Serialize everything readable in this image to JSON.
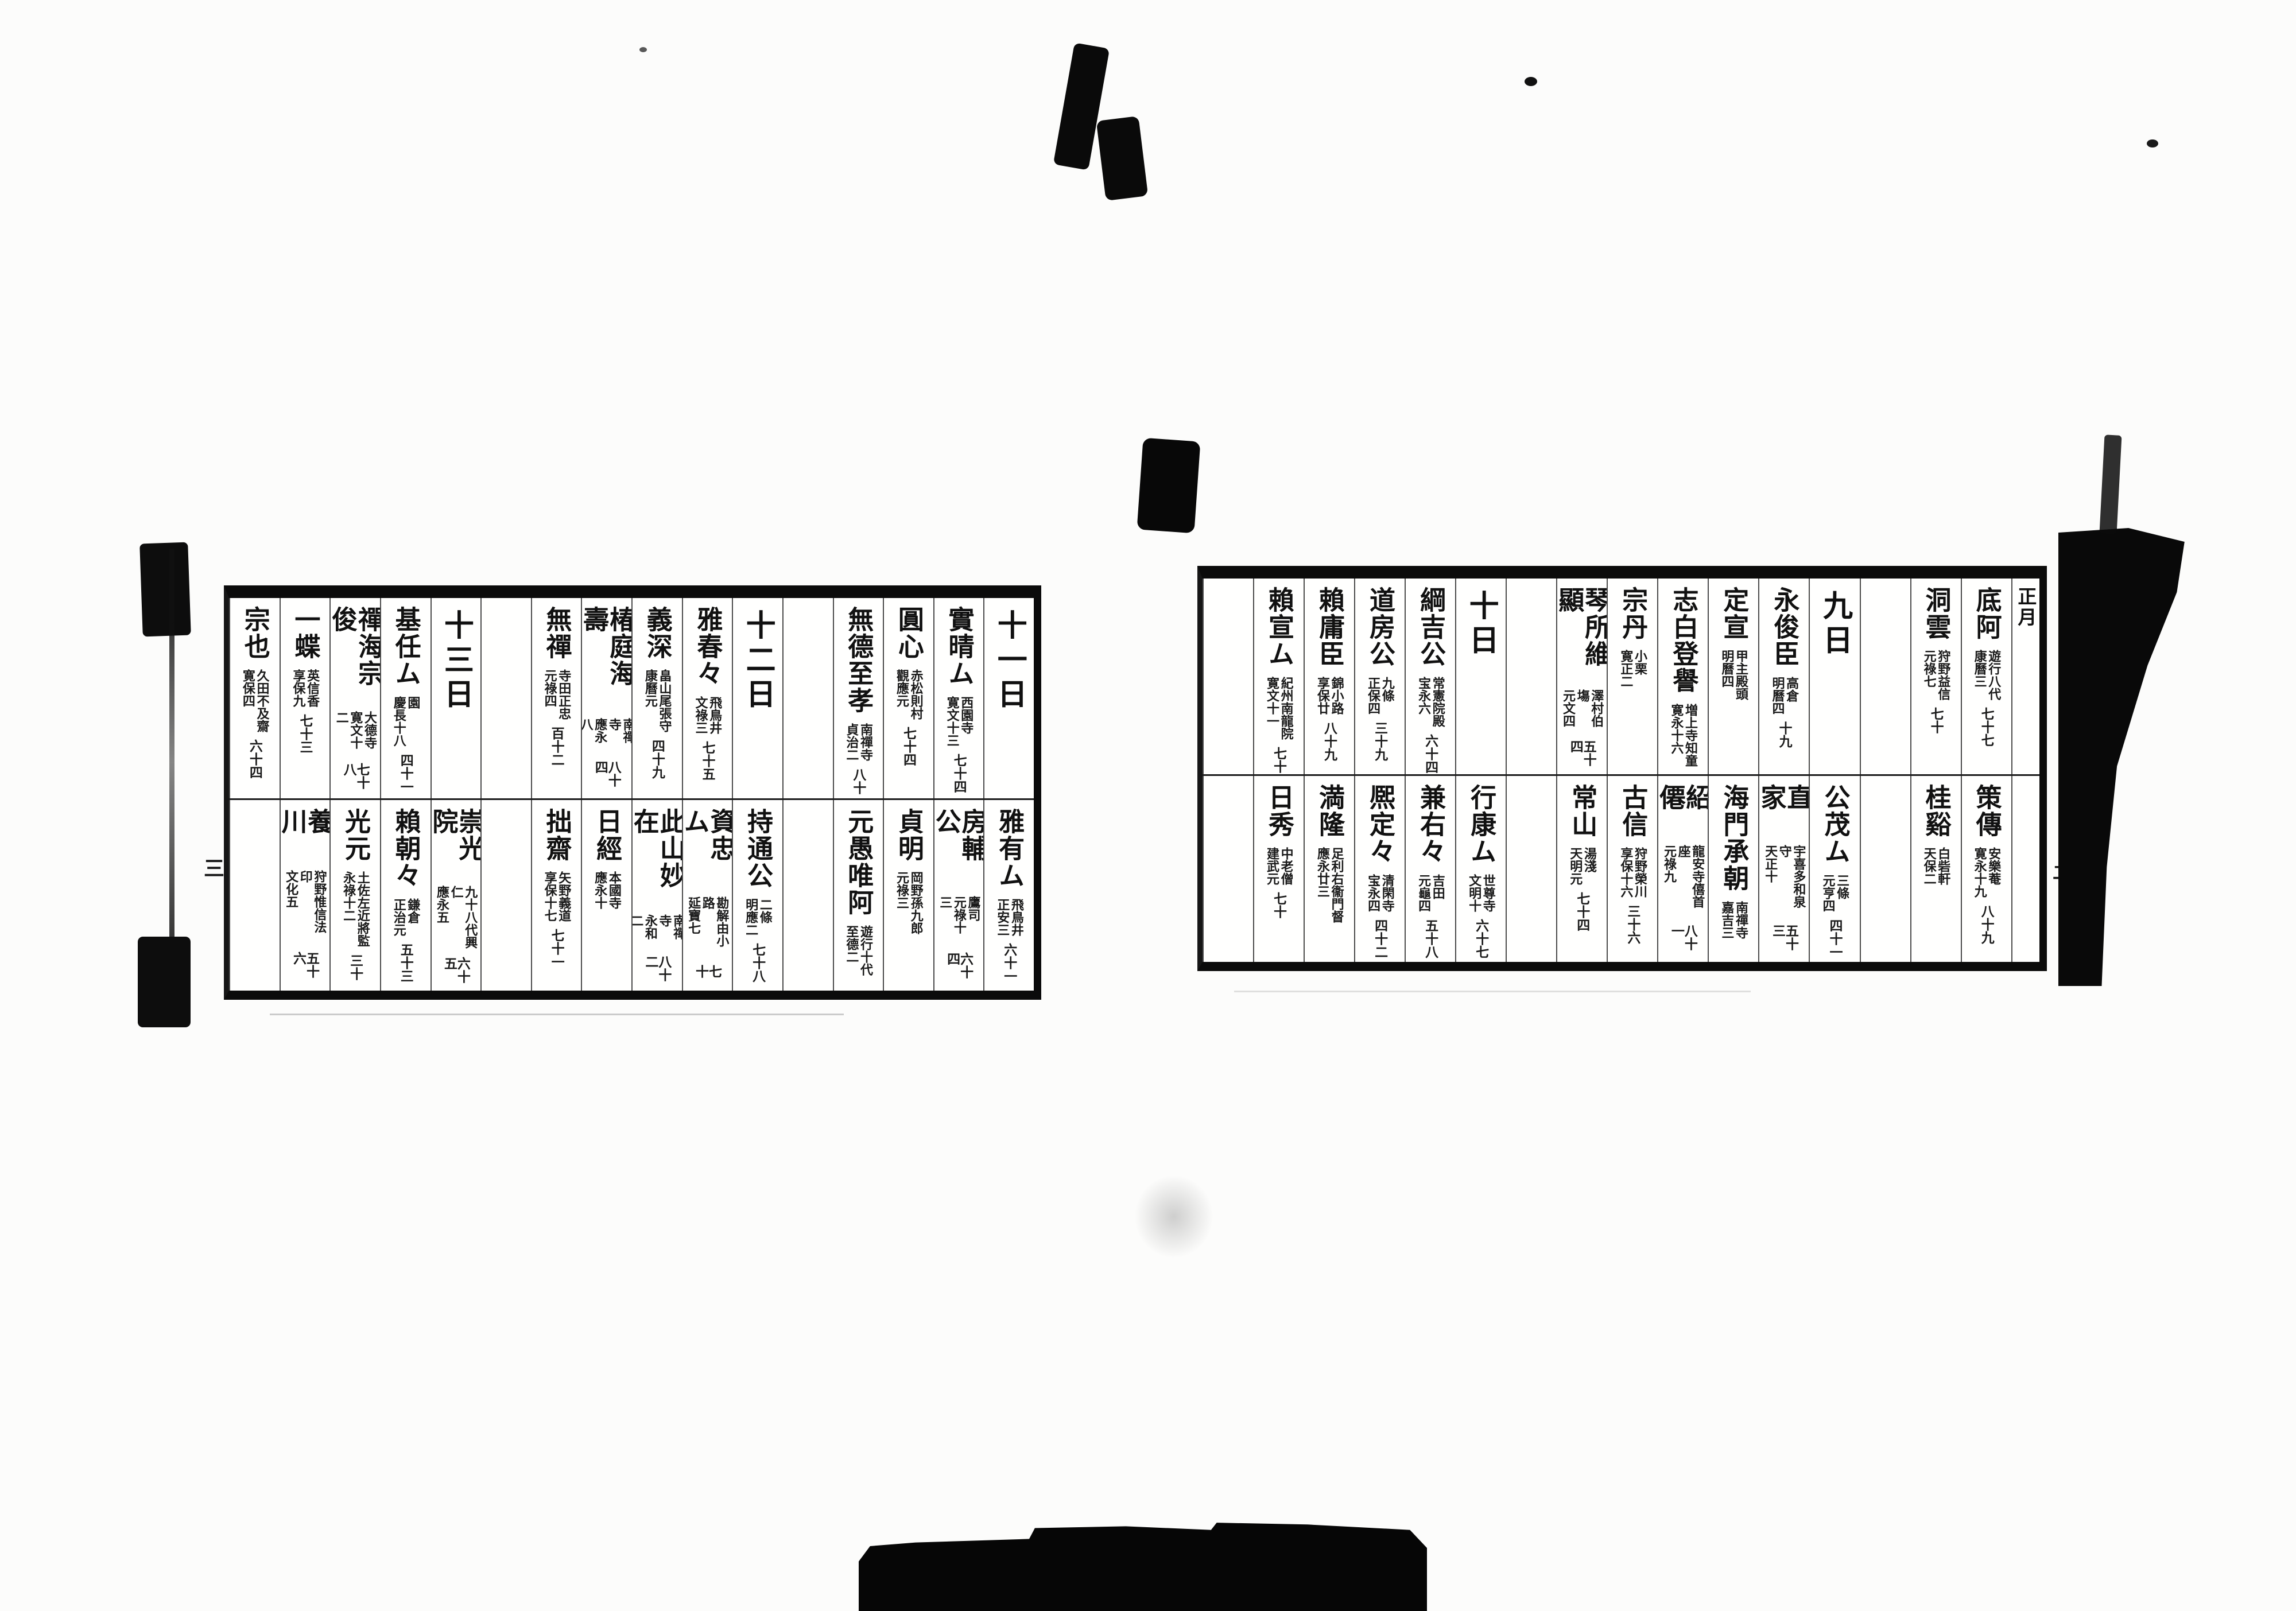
{
  "spread": {
    "pages": {
      "right": {
        "page_number": "二",
        "columns": [
          {
            "narrow": true,
            "top": {
              "header": "正月",
              "month": true
            },
            "bottom": null
          },
          {
            "top": {
              "name": "底阿",
              "note1": "遊行八代",
              "note2": "康曆三",
              "age": "七十七"
            },
            "bottom": {
              "name": "策傳",
              "note1": "安樂菴",
              "note2": "寛永十九",
              "age": "八十九"
            }
          },
          {
            "top": {
              "name": "洞雲",
              "note1": "狩野益信",
              "note2": "元祿七",
              "age": "七十"
            },
            "bottom": {
              "name": "桂谿",
              "note1": "白砦軒",
              "note2": "天保二",
              "age": ""
            }
          },
          {
            "top": null,
            "bottom": null
          },
          {
            "top": {
              "header": "九日"
            },
            "bottom": {
              "name": "公茂ム",
              "note1": "三條",
              "note2": "元亨四",
              "age": "四十一"
            }
          },
          {
            "top": {
              "name": "永俊臣",
              "note1": "高倉",
              "note2": "明曆四",
              "age": "十九"
            },
            "bottom": {
              "name": "直家",
              "note1": "宇喜多和泉守",
              "note2": "天正十",
              "age": "五十三"
            }
          },
          {
            "top": {
              "name": "定宣",
              "note1": "甲主殿頭",
              "note2": "明曆四",
              "age": ""
            },
            "bottom": {
              "name": "海門承朝",
              "note1": "南禪寺",
              "note2": "嘉吉三",
              "age": ""
            }
          },
          {
            "top": {
              "name": "志白登譽",
              "note1": "増上寺知童",
              "note2": "寛永十六",
              "age": ""
            },
            "bottom": {
              "name": "紹僊",
              "note1": "龍安寺僖首座",
              "note2": "元祿九",
              "age": "八十一"
            }
          },
          {
            "top": {
              "name": "宗丹",
              "note1": "小栗",
              "note2": "寛正二",
              "age": ""
            },
            "bottom": {
              "name": "古信",
              "note1": "狩野榮川",
              "note2": "享保十六",
              "age": "三十六"
            }
          },
          {
            "top": {
              "name": "琴所維顯",
              "note1": "澤村伯塲",
              "note2": "元文四",
              "age": "五十四"
            },
            "bottom": {
              "name": "常山",
              "note1": "湯淺",
              "note2": "天明元",
              "age": "七十四"
            }
          },
          {
            "top": null,
            "bottom": null
          },
          {
            "top": {
              "header": "十日"
            },
            "bottom": {
              "name": "行康ム",
              "note1": "世尊寺",
              "note2": "文明十",
              "age": "六十七"
            }
          },
          {
            "top": {
              "name": "綱吉公",
              "note1": "常憲院殿",
              "note2": "宝永六",
              "age": "六十四"
            },
            "bottom": {
              "name": "兼右々",
              "note1": "吉田",
              "note2": "元龜四",
              "age": "五十八"
            }
          },
          {
            "top": {
              "name": "道房公",
              "note1": "九條",
              "note2": "正保四",
              "age": "三十九"
            },
            "bottom": {
              "name": "熈定々",
              "note1": "清閑寺",
              "note2": "宝永四",
              "age": "四十二"
            }
          },
          {
            "top": {
              "name": "賴庸臣",
              "note1": "錦小路",
              "note2": "享保廿",
              "age": "八十九"
            },
            "bottom": {
              "name": "満隆",
              "note1": "足利右衞門督",
              "note2": "應永廿三",
              "age": ""
            }
          },
          {
            "top": {
              "name": "賴宣ム",
              "note1": "紀州南龍院",
              "note2": "寛文十一",
              "age": "七十"
            },
            "bottom": {
              "name": "日秀",
              "note1": "中老僧",
              "note2": "建武元",
              "age": "七十"
            }
          },
          {
            "top": null,
            "bottom": null
          }
        ]
      },
      "left": {
        "page_number": "三",
        "columns": [
          {
            "top": {
              "header": "十一日"
            },
            "bottom": {
              "name": "雅有ム",
              "note1": "飛鳥井",
              "note2": "正安三",
              "age": "六十一"
            }
          },
          {
            "top": {
              "name": "實晴ム",
              "note1": "西園寺",
              "note2": "寛文十三",
              "age": "七十四"
            },
            "bottom": {
              "name": "房輔公",
              "note1": "鷹司",
              "note2": "元祿十三",
              "age": "六十四"
            }
          },
          {
            "top": {
              "name": "圓心",
              "note1": "赤松則村",
              "note2": "觀應元",
              "age": "七十四"
            },
            "bottom": {
              "name": "貞明",
              "note1": "岡野孫九郎",
              "note2": "元祿三",
              "age": ""
            }
          },
          {
            "top": {
              "name": "無德至孝",
              "note1": "南禪寺",
              "note2": "貞治二",
              "age": "八十"
            },
            "bottom": {
              "name": "元愚唯阿",
              "note1": "遊行十代",
              "note2": "至德二",
              "age": ""
            }
          },
          {
            "top": null,
            "bottom": null
          },
          {
            "top": {
              "header": "十二日"
            },
            "bottom": {
              "name": "持通公",
              "note1": "二條",
              "note2": "明應二",
              "age": "七十八"
            }
          },
          {
            "top": {
              "name": "雅春々",
              "note1": "飛鳥井",
              "note2": "文祿三",
              "age": "七十五"
            },
            "bottom": {
              "name": "資忠ム",
              "note1": "勘解由小路",
              "note2": "延寶七",
              "age": "七十"
            }
          },
          {
            "top": {
              "name": "義深",
              "note1": "畠山尾張守",
              "note2": "康曆元",
              "age": "四十九"
            },
            "bottom": {
              "name": "此山妙在",
              "note1": "南禪寺",
              "note2": "永和二",
              "age": "八十二"
            }
          },
          {
            "top": {
              "name": "椿庭海壽",
              "note1": "南禪寺",
              "note2": "應永八",
              "age": "八十四"
            },
            "bottom": {
              "name": "日經",
              "note1": "本國寺",
              "note2": "應永十",
              "age": ""
            }
          },
          {
            "top": {
              "name": "無禪",
              "note1": "寺田正忠",
              "note2": "元祿四",
              "age": "百十二"
            },
            "bottom": {
              "name": "拙齋",
              "note1": "矢野義道",
              "note2": "享保十七",
              "age": "七十一"
            }
          },
          {
            "top": null,
            "bottom": null
          },
          {
            "top": {
              "header": "十三日"
            },
            "bottom": {
              "name": "崇光院",
              "note1": "九十八代興仁",
              "note2": "應永五",
              "age": "六十五"
            }
          },
          {
            "top": {
              "name": "基任ム",
              "note1": "園",
              "note2": "慶長十八",
              "age": "四十一"
            },
            "bottom": {
              "name": "賴朝々",
              "note1": "鎌倉",
              "note2": "正治元",
              "age": "五十三"
            }
          },
          {
            "top": {
              "name": "禪海宗俊",
              "note1": "大德寺",
              "note2": "寛文十二",
              "age": "七十八"
            },
            "bottom": {
              "name": "光元",
              "note1": "土佐左近將監",
              "note2": "永祿十二",
              "age": "三十"
            }
          },
          {
            "top": {
              "name": "一蝶",
              "note1": "英信香",
              "note2": "享保九",
              "age": "七十三"
            },
            "bottom": {
              "name": "養川",
              "note1": "狩野惟信法印",
              "note2": "文化五",
              "age": "五十六"
            }
          },
          {
            "top": {
              "name": "宗也",
              "note1": "久田不及齋",
              "note2": "寛保四",
              "age": "六十四"
            },
            "bottom": null
          }
        ]
      }
    }
  }
}
